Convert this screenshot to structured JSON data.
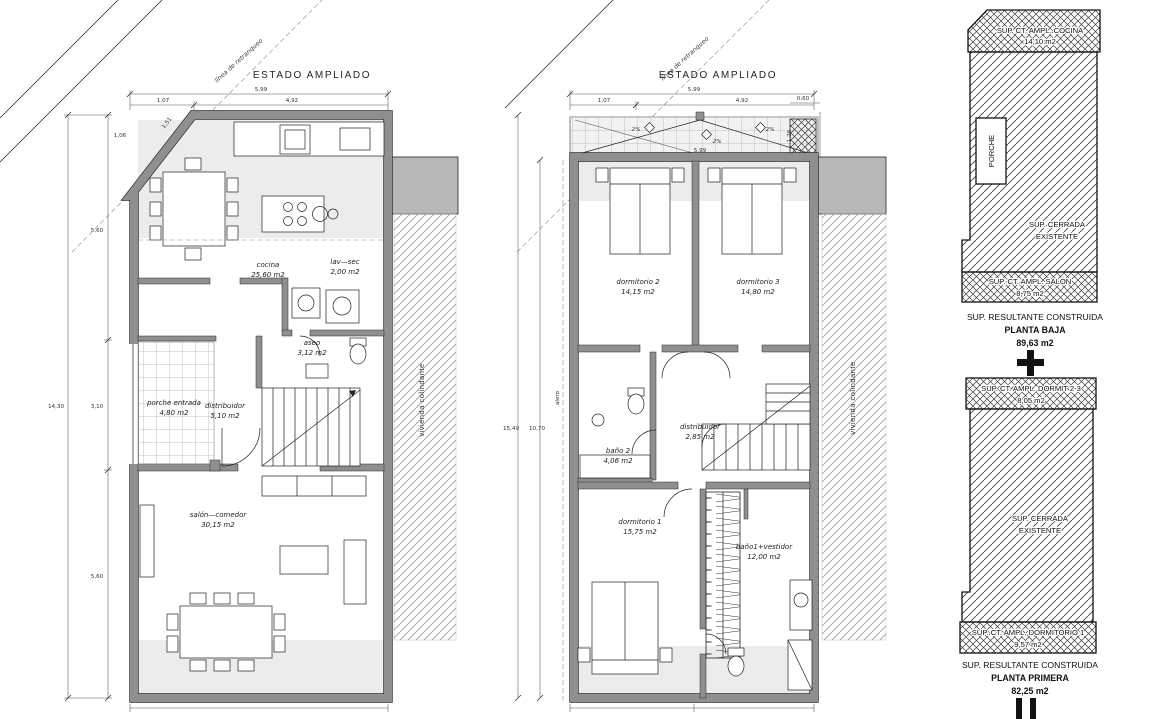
{
  "plan_baja": {
    "title": "ESTADO AMPLIADO",
    "setback_label": "línea de retranqueo",
    "neighbor_label": "vivienda colindante",
    "rooms": {
      "cocina": {
        "name": "cocina",
        "area": "25,60 m2"
      },
      "lavsec": {
        "name": "lav—sec",
        "area": "2,00 m2"
      },
      "aseo": {
        "name": "aseo",
        "area": "3,12 m2"
      },
      "distribuidor": {
        "name": "distribuidor",
        "area": "5,10 m2"
      },
      "porche": {
        "name": "porche entrada",
        "area": "4,80 m2"
      },
      "salon": {
        "name": "salón—comedor",
        "area": "30,15 m2"
      }
    },
    "dims": {
      "top_total": "5,99",
      "top_a": "1,07",
      "top_b": "4,92",
      "diag": "1,51",
      "v_top": "1,06",
      "v_a": "5,60",
      "v_b": "3,10",
      "v_c": "5,60",
      "v_total": "14,30"
    }
  },
  "plan_primera": {
    "title": "ESTADO AMPLIADO",
    "setback_label": "línea de retranqueo",
    "neighbor_label": "vivienda colindante",
    "alero_label": "alero",
    "slope_label": "2%",
    "rooms": {
      "dorm2": {
        "name": "dormitorio 2",
        "area": "14,15 m2"
      },
      "dorm3": {
        "name": "dormitorio 3",
        "area": "14,80 m2"
      },
      "distribuidor": {
        "name": "distribuidor",
        "area": "2,85 m2"
      },
      "bano2": {
        "name": "baño 2",
        "area": "4,06 m2"
      },
      "dorm1": {
        "name": "dormitorio 1",
        "area": "15,75 m2"
      },
      "bano1": {
        "name": "baño1+vestidor",
        "area": "12,00 m2"
      }
    },
    "dims": {
      "top_total": "5,99",
      "top_a": "1,07",
      "top_b": "4,92",
      "right_a": "0,60",
      "right_b": "1,26",
      "terrace": "5,99",
      "v_total": "15,49",
      "v_inner": "10,70"
    }
  },
  "summary": {
    "baja": {
      "ampl_top_label": "SUP. CT. AMPL. COCINA",
      "ampl_top_area": "14,10 m2",
      "porche_label": "PORCHE",
      "existing_line1": "SUP. CERRADA",
      "existing_line2": "EXISTENTE",
      "ampl_bottom_label": "SUP. CT. AMPL. SALÓN",
      "ampl_bottom_area": "8,75 m2",
      "result_label": "SUP. RESULTANTE CONSTRUIDA",
      "result_name": "PLANTA BAJA",
      "result_area": "89,63 m2"
    },
    "primera": {
      "ampl_top_label": "SUP. CT. AMPL. DORMIT 2-3",
      "ampl_top_area": "8,05 m2",
      "existing_line1": "SUP. CERRADA",
      "existing_line2": "EXISTENTE",
      "ampl_bottom_label": "SUP. CT. AMPL. DORMITORIO 1",
      "ampl_bottom_area": "9,57 m2",
      "result_label": "SUP. RESULTANTE CONSTRUIDA",
      "result_name": "PLANTA PRIMERA",
      "result_area": "82,25 m2"
    }
  },
  "colors": {
    "wall": "#8f8f8f",
    "tint": "#ececec",
    "neighbor_block": "#b8b8b8"
  }
}
